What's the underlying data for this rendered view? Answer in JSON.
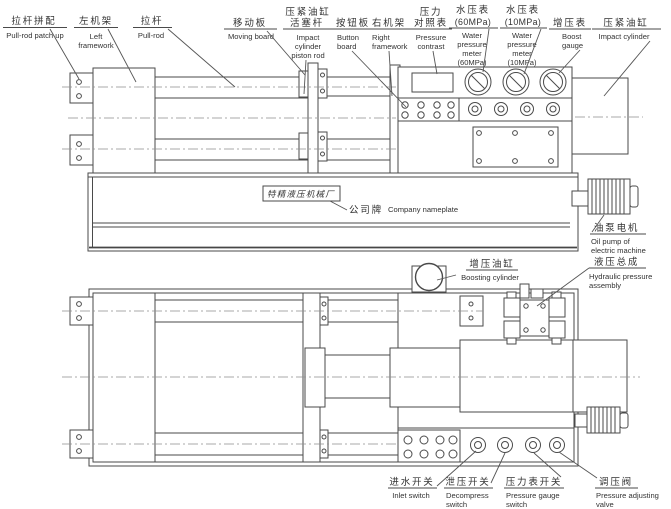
{
  "diagram": {
    "kind": "hydraulic press machine assembly drawing, two views",
    "colors": {
      "line": "#4a4a4a",
      "text": "#333333",
      "background": "#ffffff"
    },
    "nameplate": {
      "text": "特精液压机械厂"
    },
    "labels": {
      "pull_rod_patch_up": {
        "zh": "拉杆拼配",
        "en": "Pull-rod patch up"
      },
      "left_framework": {
        "zh": "左机架",
        "en1": "Left",
        "en2": "framework"
      },
      "pull_rod": {
        "zh": "拉杆",
        "en": "Pull-rod"
      },
      "moving_board": {
        "zh": "移动板",
        "en": "Moving board"
      },
      "piston_rod": {
        "zh1": "压紧油缸",
        "zh2": "活塞杆",
        "en1": "Impact",
        "en2": "cylinder",
        "en3": "piston rod"
      },
      "button_board": {
        "zh": "按钮板",
        "en1": "Button",
        "en2": "board"
      },
      "right_framework": {
        "zh": "右机架",
        "en1": "Right",
        "en2": "framework"
      },
      "pressure_contrast": {
        "zh1": "压力",
        "zh2": "对照表",
        "en1": "Pressure",
        "en2": "contrast"
      },
      "water_meter_60": {
        "zh1": "水压表",
        "zh2": "(60MPa)",
        "en1": "Water",
        "en2": "pressure",
        "en3": "meter",
        "en4": "(60MPa)"
      },
      "water_meter_10": {
        "zh1": "水压表",
        "zh2": "(10MPa)",
        "en1": "Water",
        "en2": "pressure",
        "en3": "meter",
        "en4": "(10MPa)"
      },
      "boost_gauge": {
        "zh": "增压表",
        "en1": "Boost",
        "en2": "gauge"
      },
      "impact_cylinder": {
        "zh": "压紧油缸",
        "en": "Impact cylinder"
      },
      "company_nameplate": {
        "zh": "公司牌",
        "en": "Company nameplate"
      },
      "oil_pump": {
        "zh": "油泵电机",
        "en1": "Oil pump of",
        "en2": "electric machine"
      },
      "hydraulic_assembly": {
        "zh": "液压总成",
        "en1": "Hydraulic pressure",
        "en2": "assembly"
      },
      "boosting_cylinder": {
        "zh": "增压油缸",
        "en": "Boosting cylinder"
      },
      "inlet_switch": {
        "zh": "进水开关",
        "en": "Inlet switch"
      },
      "decompress_switch": {
        "zh": "泄压开关",
        "en1": "Decompress",
        "en2": "switch"
      },
      "pressure_gauge_switch": {
        "zh": "压力表开关",
        "en1": "Pressure gauge",
        "en2": "switch"
      },
      "pressure_adjusting_valve": {
        "zh": "调压阀",
        "en1": "Pressure adjusting",
        "en2": "valve"
      }
    }
  }
}
